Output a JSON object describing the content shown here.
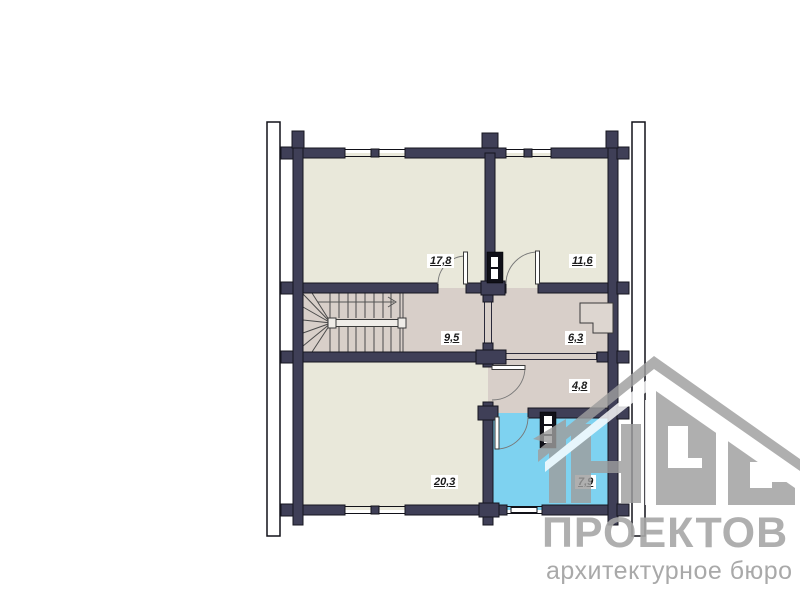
{
  "plan": {
    "rooms": [
      {
        "id": "room-top-left",
        "area": "17,8"
      },
      {
        "id": "room-top-right",
        "area": "11,6"
      },
      {
        "id": "hall-stairs",
        "area": "9,5"
      },
      {
        "id": "room-wardrobe",
        "area": "6,3"
      },
      {
        "id": "room-corridor",
        "area": "4,8"
      },
      {
        "id": "room-bottom-left",
        "area": "20,3"
      },
      {
        "id": "bathroom",
        "area": "7,9"
      }
    ]
  },
  "logo": {
    "icon": "house-logo",
    "title": "ПРОЕКТОВ",
    "subtitle": "архитектурное бюро"
  },
  "colors": {
    "wall": "#3f3f57",
    "wall_outline": "#15151f",
    "floor_beige": "#e9e8da",
    "floor_mauve": "#d8cfc9",
    "floor_bath_blue": "#7ed2f0",
    "watermark_gray": "#9e9e9e",
    "watermark_text": "#a7a7a7"
  }
}
